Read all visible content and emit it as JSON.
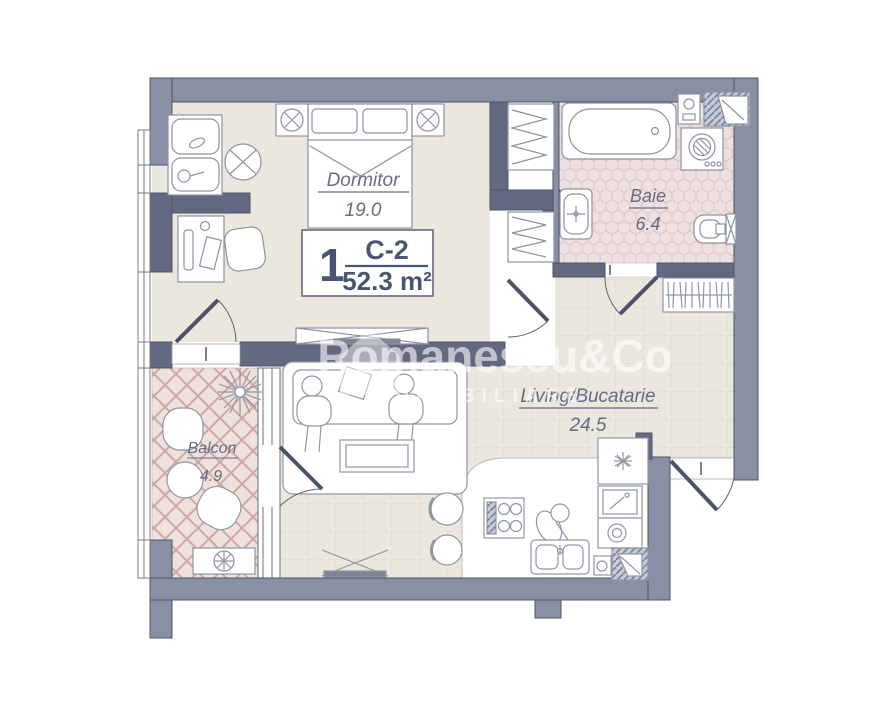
{
  "unit": {
    "number": "1",
    "code": "C-2",
    "area": "52.3 m²"
  },
  "rooms": [
    {
      "name": "Dormitor",
      "area": "19.0"
    },
    {
      "name": "Baie",
      "area": "6.4"
    },
    {
      "name": "Living/Bucatarie",
      "area": "24.5"
    },
    {
      "name": "Balcon",
      "area": "4.9"
    }
  ],
  "watermark": {
    "name": "Romanescu&Co",
    "tagline": "IMOBILIARE"
  },
  "colors": {
    "wall_exterior": "#8a90a3",
    "wall_interior": "#626980",
    "floor_beige": "#eae7df",
    "bath_floor": "#efe0e0",
    "balcony_floor": "#eee0dc",
    "label_text": "#666d83",
    "unit_text": "#4a5572"
  }
}
